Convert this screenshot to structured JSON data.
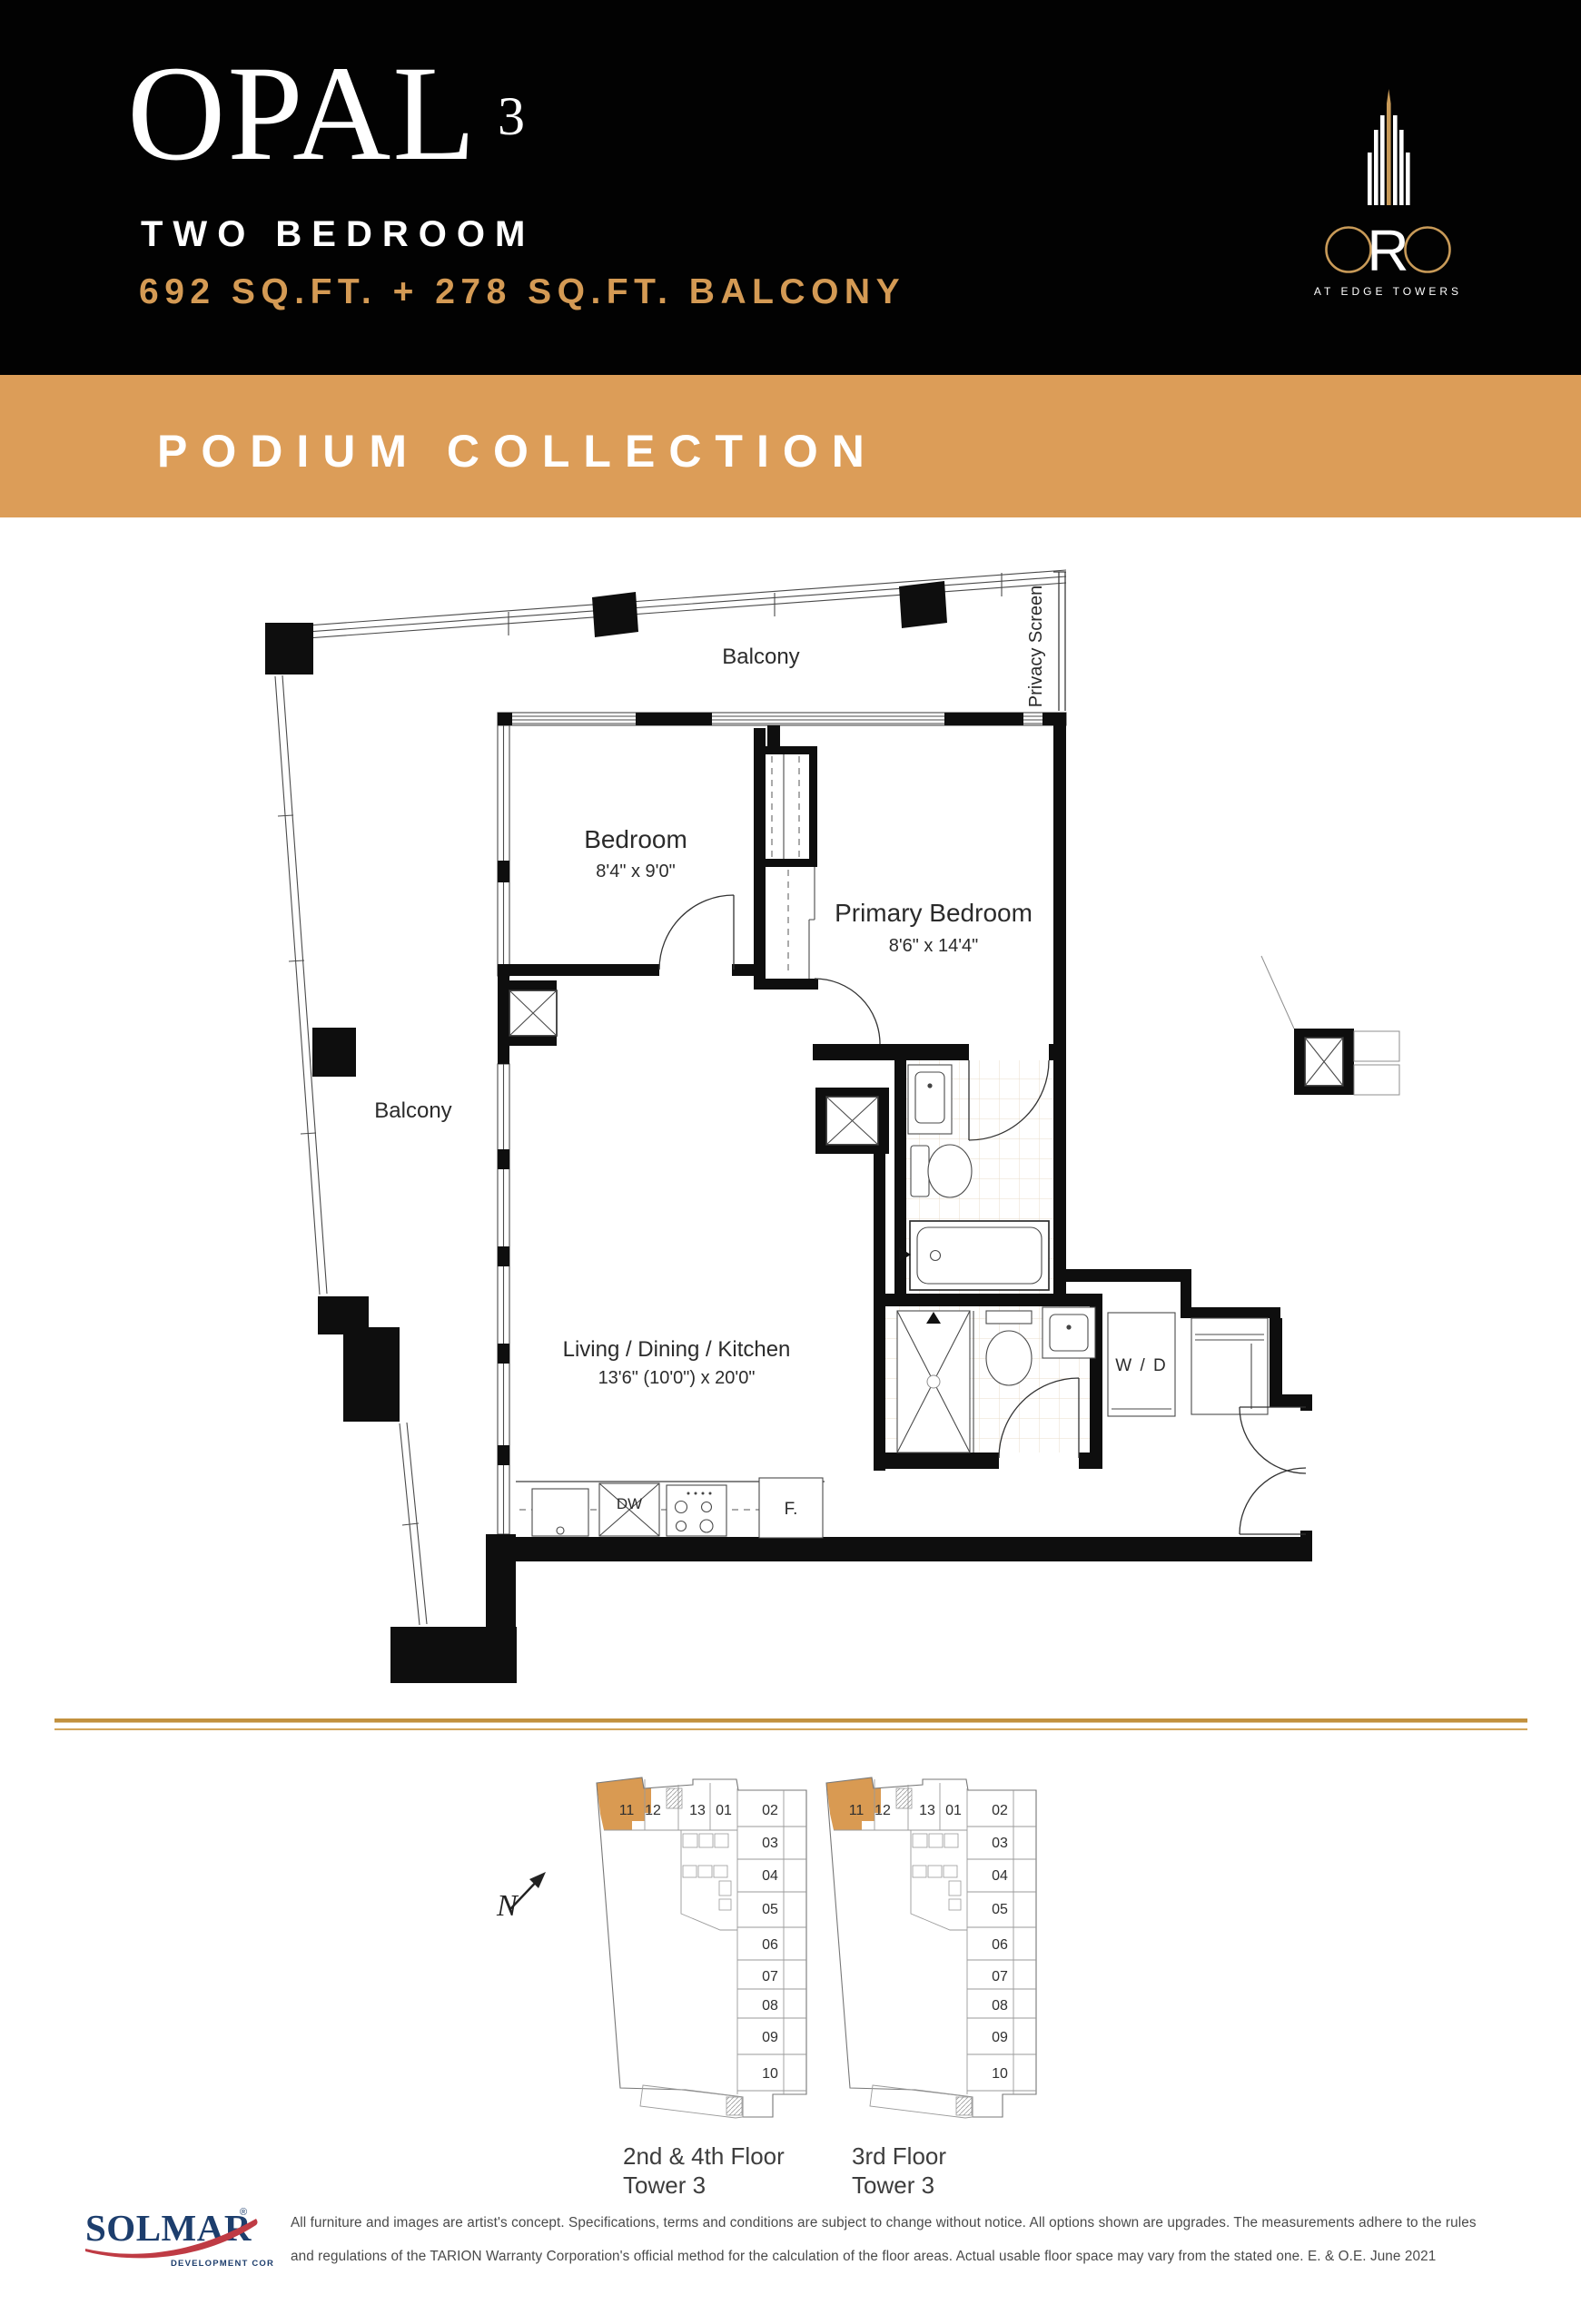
{
  "header": {
    "title": "OPAL",
    "title_sup": "3",
    "subtitle": "TWO BEDROOM",
    "area": "692 SQ.FT. + 278 SQ.FT. BALCONY",
    "bg_color": "#020202",
    "area_color": "#D49A54"
  },
  "logo": {
    "letter_r": "R",
    "tagline": "AT EDGE TOWERS",
    "gold": "#C89A58"
  },
  "banner": {
    "label": "PODIUM COLLECTION",
    "bg_color": "#DC9D58"
  },
  "floor_plan": {
    "rooms": {
      "balcony_top": "Balcony",
      "balcony_left": "Balcony",
      "bedroom": {
        "name": "Bedroom",
        "dims": "8'4\" x 9'0\""
      },
      "primary": {
        "name": "Primary Bedroom",
        "dims": "8'6\" x 14'4\""
      },
      "living": {
        "name": "Living / Dining / Kitchen",
        "dims": "13'6\" (10'0\") x 20'0\""
      }
    },
    "labels": {
      "privacy_screen": "Privacy Screen",
      "dishwasher": "DW",
      "fridge": "F.",
      "washer_dryer": "W / D"
    }
  },
  "key_plans": {
    "north_label": "N",
    "unit_numbers": [
      "11",
      "12",
      "13",
      "01",
      "02",
      "03",
      "04",
      "05",
      "06",
      "07",
      "08",
      "09",
      "10"
    ],
    "highlighted_unit": "11",
    "highlight_color": "#D99A52",
    "plates": [
      {
        "caption_line1": "2nd & 4th Floor",
        "caption_line2": "Tower 3"
      },
      {
        "caption_line1": "3rd Floor",
        "caption_line2": "Tower 3"
      }
    ]
  },
  "footer": {
    "developer": "SOLMAR",
    "registered": "®",
    "developer_sub": "DEVELOPMENT CORP.",
    "disclaimer_line1": "All furniture and images are artist's concept. Specifications, terms and conditions are subject to change without notice. All options shown are upgrades. The measurements adhere to the rules",
    "disclaimer_line2": "and regulations of the TARION Warranty Corporation's official method for the calculation of the floor areas. Actual usable floor space may vary from the stated one. E. & O.E. June 2021"
  }
}
